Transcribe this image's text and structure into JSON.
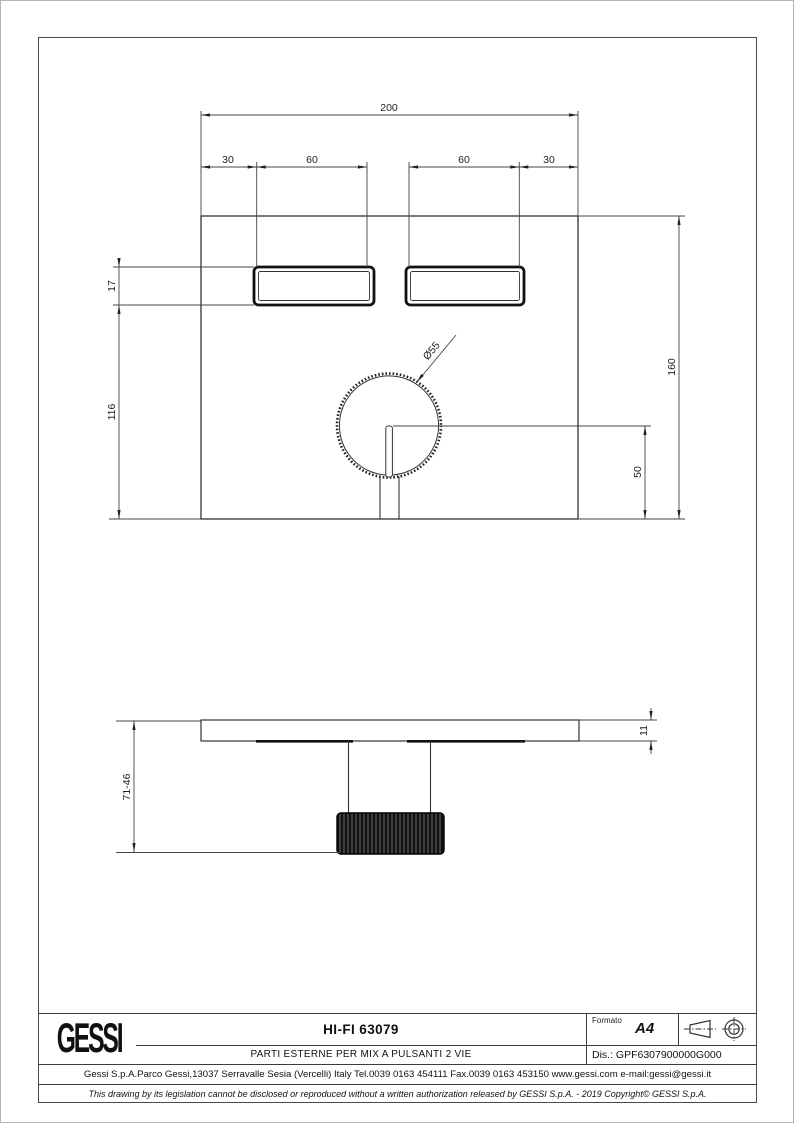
{
  "dimensions": {
    "top_view": {
      "overall_width": "200",
      "left_margin": "30",
      "button1_width": "60",
      "button2_width": "60",
      "right_margin": "30",
      "button_height": "17",
      "button_to_bottom": "116",
      "overall_height": "160",
      "knob_center_to_bottom": "50",
      "knob_diameter": "Ø55"
    },
    "side_view": {
      "total_depth": "71-46",
      "plate_thickness": "11"
    }
  },
  "title_block": {
    "logo": "GESSI",
    "product_code": "HI-FI 63079",
    "description": "PARTI ESTERNE PER MIX A PULSANTI 2 VIE",
    "format_label": "Formato",
    "format_value": "A4",
    "drawing_number": "Dis.: GPF6307900000G000",
    "address": "Gessi S.p.A.Parco Gessi,13037 Serravalle Sesia (Vercelli) Italy Tel.0039 0163 454111 Fax.0039 0163 453150 www.gessi.com e-mail:gessi@gessi.it",
    "disclaimer": "This drawing by its legislation cannot be disclosed or reproduced without a written authorization released by GESSI S.p.A. - 2019 Copyright© GESSI S.p.A."
  }
}
